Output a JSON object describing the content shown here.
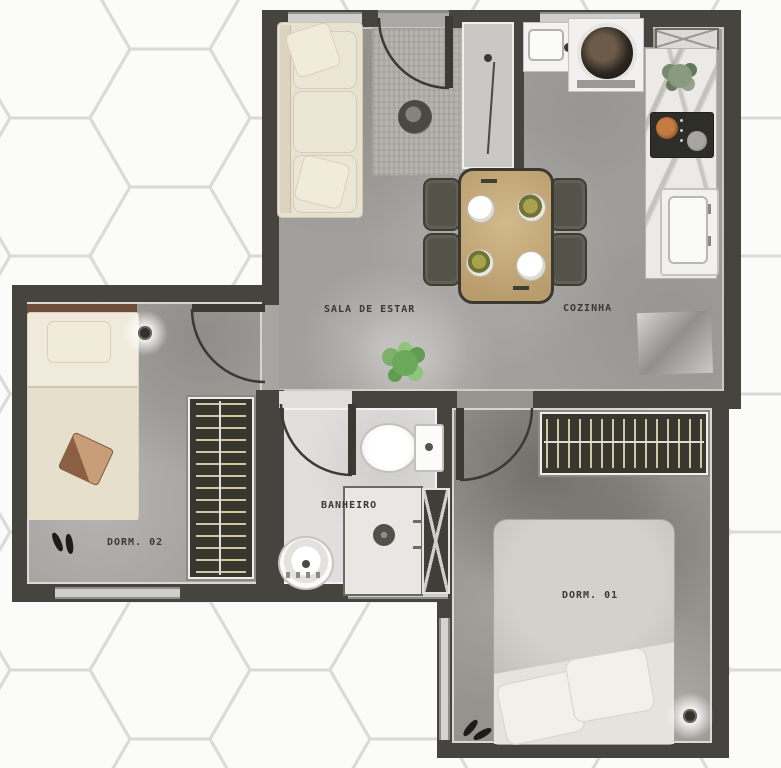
{
  "plan": {
    "type": "apartment-floor-plan",
    "rooms": [
      {
        "id": "sala-de-estar",
        "label": "SALA DE ESTAR",
        "furniture": [
          "sofa",
          "rug",
          "side-table",
          "dining-table",
          "dining-chair-x4",
          "plate-x4",
          "plant",
          "entry-door",
          "entry-mirror-cabinet"
        ]
      },
      {
        "id": "cozinha",
        "label": "COZINHA",
        "furniture": [
          "kitchen-sink",
          "washing-machine",
          "counter",
          "counter-plant",
          "cooktop",
          "fridge",
          "floor-mat",
          "vent-hatch"
        ]
      },
      {
        "id": "dorm-02",
        "label": "DORM. 02",
        "furniture": [
          "single-bed",
          "pillow",
          "bag",
          "shoes",
          "ceiling-light",
          "wardrobe",
          "door",
          "window"
        ]
      },
      {
        "id": "banheiro",
        "label": "BANHEIRO",
        "furniture": [
          "toilet",
          "pedestal-sink",
          "shower-box",
          "duct-shaft",
          "door",
          "window"
        ]
      },
      {
        "id": "dorm-01",
        "label": "DORM. 01",
        "furniture": [
          "double-bed",
          "pillow-x2",
          "shoes",
          "ceiling-light",
          "wardrobe",
          "door",
          "window"
        ]
      }
    ],
    "colors": {
      "wall": "#45443f",
      "floor_concrete": "#a2a09c",
      "floor_dorm01": "#95938d",
      "floor_bathroom": "#e0dfdd",
      "furniture_beige": "#e7e1d0",
      "table_wood": "#c4a878",
      "chair_gray": "#53534a",
      "wardrobe_dark": "#38372e",
      "hanger_beige": "#d2c6a6",
      "plant_green": "#7db06a",
      "background": "#fbfbfa",
      "hex_line": "#dadad8"
    }
  }
}
